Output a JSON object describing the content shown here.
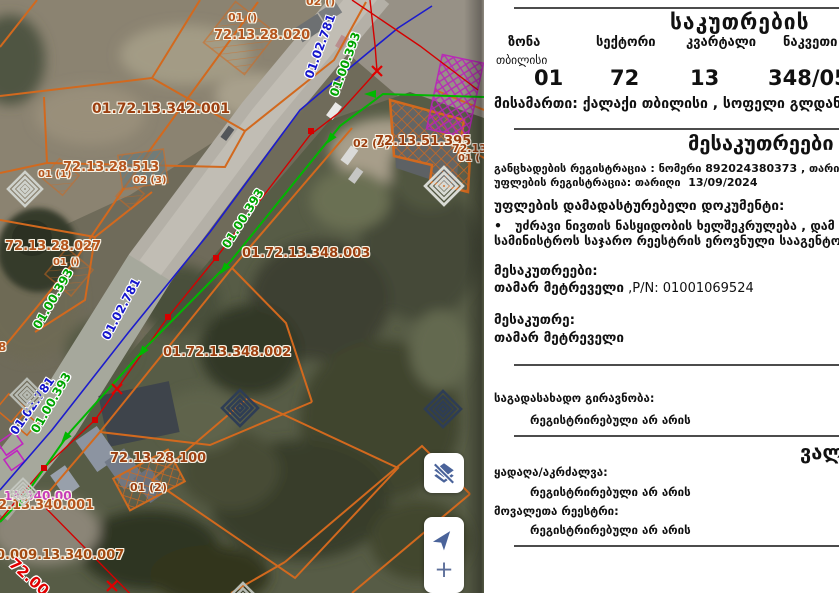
{
  "panel": {
    "title": "საკუთრების",
    "columns": [
      {
        "label": "ზონა",
        "sub": "თბილისი",
        "value": "01"
      },
      {
        "label": "სექტორი",
        "value": "72"
      },
      {
        "label": "კვარტალი",
        "value": "13"
      },
      {
        "label": "ნაკვეთი",
        "value": "348/05"
      }
    ],
    "address": "მისამართი: ქალაქი თბილისი , სოფელი გლდანი",
    "owner_section": {
      "heading": "მესაკუთრეები",
      "application_registration": "განცხადების რეგისტრაცია : ნომერი 892024380373 , თარიღი 13/09/2024",
      "right_registration": "უფლების რეგისტრაცია: თარიღი  13/09/2024",
      "document_heading": "უფლების დამადასტურებელი დოკუმენტი:",
      "document_line1": "•   უძრავი ნივთის ნასყიდობის ხელშეკრულება , დამ",
      "document_line2": "სამინისტროს საჯარო რეესტრის ეროვნული სააგენტო",
      "owners_label": "მესაკუთრეები:",
      "owner_name": "თამარ მეტრეველი",
      "owner_pn": " ,P/N: 01001069524",
      "owner_label": "მესაკუთრე:",
      "owner_name2": "თამარ მეტრეველი"
    },
    "tax_lien_label": "საგადასახადო გირავნობა:",
    "tax_lien_value": "რეგისტრირებული არ არის",
    "obligations_heading": "ვალდებულებები",
    "seizure_label": "ყადაღა/აკრძალვა:",
    "seizure_value": "რეგისტრირებული არ არის",
    "debtors_label": "მოვალეთა რეესტრი:",
    "debtors_value": "რეგისტრირებული არ არის"
  },
  "map": {
    "controls": {
      "zoom_in_label": "+"
    },
    "parcel_labels": [
      {
        "text": "01 ()",
        "x": 228,
        "y": 12,
        "size": 11,
        "color": "#b5541c"
      },
      {
        "text": "72.13.28.020",
        "x": 214,
        "y": 29,
        "size": 13,
        "color": "#b5541c"
      },
      {
        "text": "02 ()",
        "x": 306,
        "y": -4,
        "size": 11,
        "color": "#b5541c"
      },
      {
        "text": "01.72.13.342.001",
        "x": 92,
        "y": 102,
        "size": 14,
        "color": "#9c3f10"
      },
      {
        "text": "01 (1)",
        "x": 38,
        "y": 170,
        "size": 10,
        "color": "#b5541c"
      },
      {
        "text": "72.13.28.513",
        "x": 63,
        "y": 161,
        "size": 13,
        "color": "#b5541c"
      },
      {
        "text": "02 (3)",
        "x": 133,
        "y": 176,
        "size": 10,
        "color": "#b5541c"
      },
      {
        "text": "02 (3)",
        "x": 353,
        "y": 138,
        "size": 11,
        "color": "#9c3f10"
      },
      {
        "text": "72.13.51.395",
        "x": 375,
        "y": 135,
        "size": 13,
        "color": "#9c3f10"
      },
      {
        "text": "72.13",
        "x": 452,
        "y": 143,
        "size": 11,
        "color": "#9c3f10"
      },
      {
        "text": "01 (",
        "x": 458,
        "y": 154,
        "size": 10,
        "color": "#9c3f10"
      },
      {
        "text": "72.13.28.027",
        "x": 5,
        "y": 240,
        "size": 13,
        "color": "#b5541c"
      },
      {
        "text": "01 ()",
        "x": 53,
        "y": 258,
        "size": 10,
        "color": "#b5541c"
      },
      {
        "text": "01.72.13.348.003",
        "x": 242,
        "y": 247,
        "size": 13,
        "color": "#9c3f10"
      },
      {
        "text": "8",
        "x": -2,
        "y": 341,
        "size": 12,
        "color": "#b5541c"
      },
      {
        "text": "01.72.13.348.002",
        "x": 163,
        "y": 346,
        "size": 13,
        "color": "#9c3f10"
      },
      {
        "text": "72.13.28.100",
        "x": 110,
        "y": 452,
        "size": 13,
        "color": "#9c3f10"
      },
      {
        "text": "01 (2)",
        "x": 130,
        "y": 482,
        "size": 11,
        "color": "#9c3f10"
      },
      {
        "text": "13.340.00",
        "x": 4,
        "y": 490,
        "size": 12,
        "color": "#c73bb8"
      },
      {
        "text": "2.13.340.001",
        "x": -2,
        "y": 499,
        "size": 13,
        "color": "#b5541c"
      },
      {
        "text": "0.009.13.340.007",
        "x": -4,
        "y": 549,
        "size": 13,
        "color": "#a34a10"
      }
    ],
    "line_labels": [
      {
        "text": "01.02.781",
        "x": 303,
        "y": 76,
        "rot": -70,
        "color": "#1515cc",
        "size": 12
      },
      {
        "text": "01.02.781",
        "x": 100,
        "y": 336,
        "rot": -62,
        "color": "#1515cc",
        "size": 12
      },
      {
        "text": "01.02.781",
        "x": 8,
        "y": 430,
        "rot": -55,
        "color": "#1515cc",
        "size": 12
      },
      {
        "text": "01.00.393",
        "x": 328,
        "y": 94,
        "rot": -70,
        "color": "#00a400",
        "size": 12
      },
      {
        "text": "01.00.393",
        "x": 220,
        "y": 244,
        "rot": -58,
        "color": "#00a400",
        "size": 12
      },
      {
        "text": "01.00.393",
        "x": 31,
        "y": 325,
        "rot": -60,
        "color": "#00a400",
        "size": 12
      },
      {
        "text": "01.00.393",
        "x": 29,
        "y": 429,
        "rot": -60,
        "color": "#00a400",
        "size": 12
      },
      {
        "text": "72.00",
        "x": 16,
        "y": 556,
        "rot": 42,
        "color": "#e00000",
        "size": 15
      }
    ],
    "spirals": [
      {
        "x": 25,
        "y": 189,
        "size": 38,
        "color": "#cfd2cc"
      },
      {
        "x": 444,
        "y": 186,
        "size": 42,
        "color": "#d8dad4"
      },
      {
        "x": 27,
        "y": 395,
        "size": 36,
        "color": "#b8bcb4"
      },
      {
        "x": 240,
        "y": 408,
        "size": 40,
        "color": "#2e3d55"
      },
      {
        "x": 443,
        "y": 409,
        "size": 40,
        "color": "#2e3d55"
      },
      {
        "x": 23,
        "y": 492,
        "size": 30,
        "color": "#c4c7c0"
      },
      {
        "x": 243,
        "y": 601,
        "size": 40,
        "color": "#b8bcb4"
      }
    ],
    "colors": {
      "parcel_orange": "#d2691e",
      "road_line_blue": "#1c1ccd",
      "road_line_green": "#00b400",
      "road_line_red": "#d40000",
      "hatch_purple": "#bb22bb",
      "control_icon": "#4a639a"
    }
  }
}
